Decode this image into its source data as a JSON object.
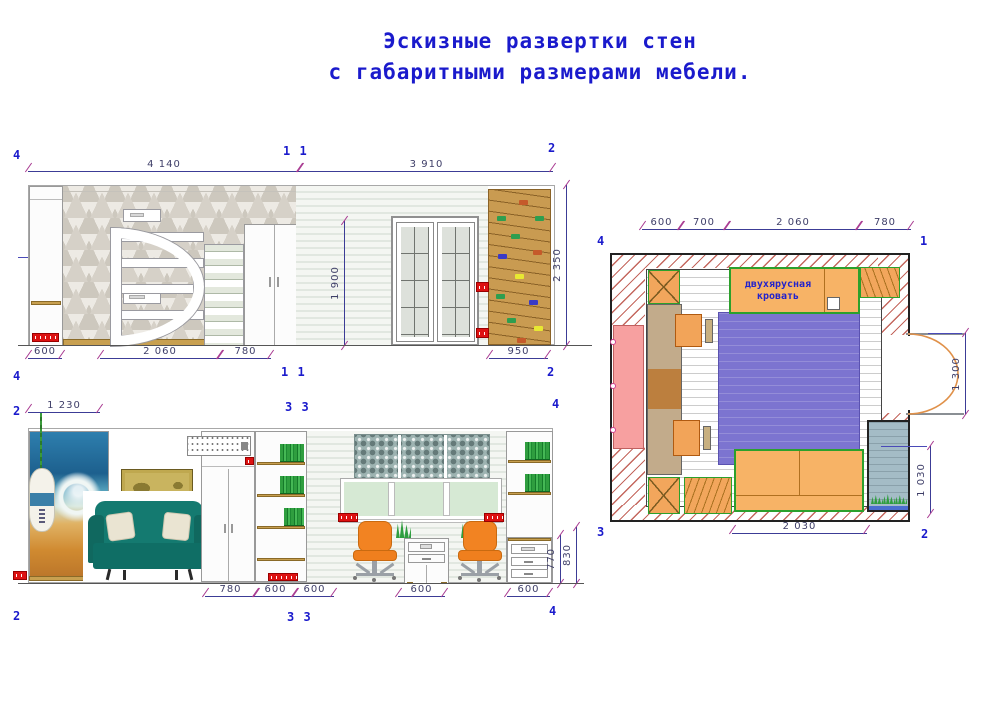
{
  "title": {
    "line1": "Эскизные развертки стен",
    "line2": "с габаритными размерами мебели."
  },
  "colors": {
    "title_text": "#1a1acc",
    "dimension_line": "#3c3c96",
    "dimension_tick": "#a83890",
    "dimension_text": "#3e3e68",
    "marker_text": "#1a1acc",
    "wall_hatch_red": "#c4675e",
    "wood": "#c8a050",
    "climbing_wall_wood": "#c99b51",
    "sofa_teal": "#147a70",
    "chair_orange": "#f28322",
    "plan_furniture_orange": "#f7b366",
    "plan_furniture_outline_green": "#2ca02c",
    "rug_purple": "#7c74d0",
    "plan_pink": "#f7a0a0",
    "balcony_blue": "#a4bcc6",
    "socket_red": "#dd1111",
    "door_arc_orange": "#e0914a"
  },
  "elev_top": {
    "marker_top_left": "4",
    "marker_top_mid": "1 1",
    "marker_top_right": "2",
    "marker_bottom_left": "4",
    "marker_bottom_mid": "1 1",
    "marker_bottom_right": "2",
    "dim_top_left": "4 140",
    "dim_top_right": "3 910",
    "dim_bottom": [
      "600",
      "2 060",
      "780",
      "950"
    ],
    "dim_door_height": "1 900",
    "dim_wall_height": "2 350"
  },
  "elev_bottom": {
    "marker_top_left": "2",
    "marker_top_mid": "3 3",
    "marker_top_right": "4",
    "marker_bottom_left": "2",
    "marker_bottom_mid": "3 3",
    "marker_bottom_right": "4",
    "dim_top": "1 230",
    "dim_bottom": [
      "780",
      "600",
      "600",
      "600",
      "600"
    ],
    "dim_desk_height": "770",
    "dim_shelf_height": "830"
  },
  "plan": {
    "marker_top_left": "4",
    "marker_top_right": "1",
    "marker_bottom_left": "3",
    "marker_bottom_right": "2",
    "dim_top": [
      "600",
      "700",
      "2 060",
      "780"
    ],
    "dim_door": "1 300",
    "dim_window": "1 030",
    "dim_bottom": "2 030",
    "bunk_bed_label": "двухярусная кровать"
  }
}
